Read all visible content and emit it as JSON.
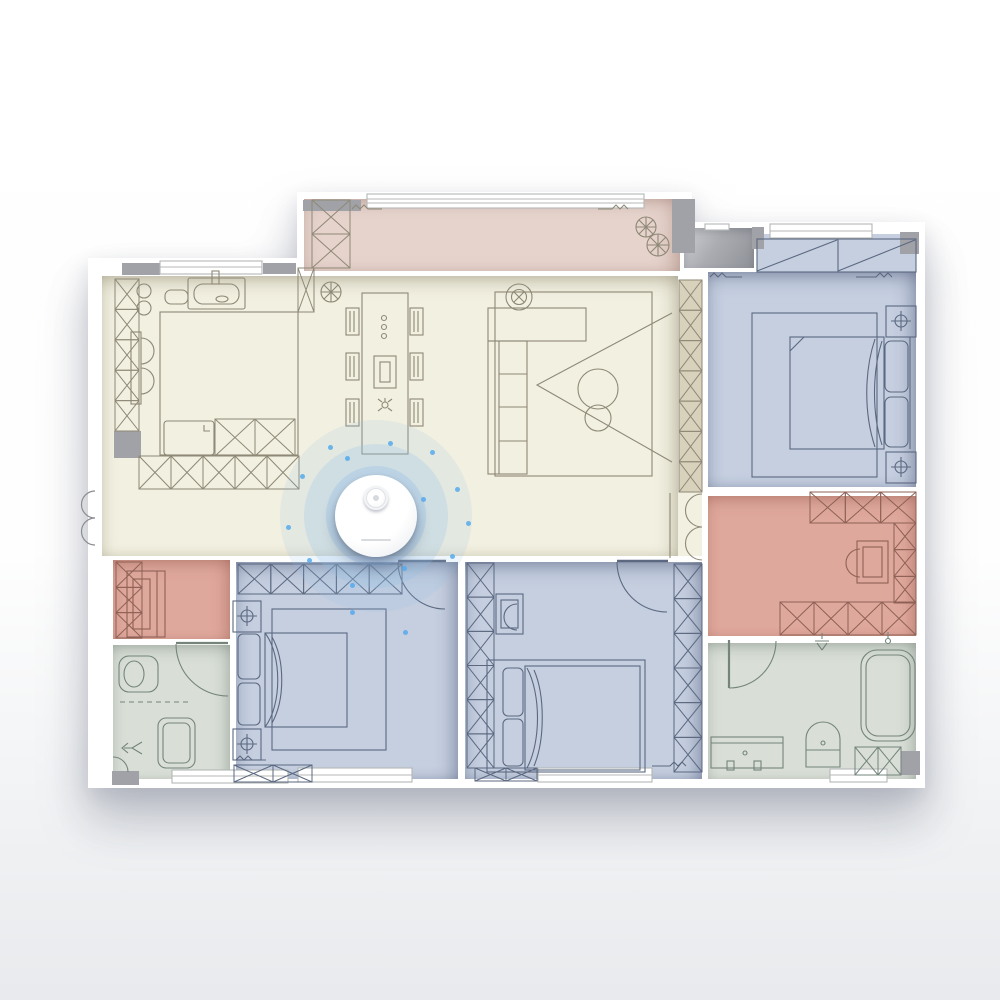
{
  "map": {
    "type": "floor-plan",
    "wall_color": "#ffffff",
    "pillar_color": "#a0a2a7",
    "background_top": "#ffffff",
    "background_bottom": "#e8eaed"
  },
  "rooms": [
    {
      "id": "balcony",
      "label": "balcony",
      "color": "#e6d3cc"
    },
    {
      "id": "living",
      "label": "living-dining-kitchen",
      "color": "#f2f0e1"
    },
    {
      "id": "bedroom-right",
      "label": "bedroom-top-right",
      "color": "#c5cfe0"
    },
    {
      "id": "study",
      "label": "study-right",
      "color": "#dfa89c"
    },
    {
      "id": "bathroom-right",
      "label": "bathroom-bottom-right",
      "color": "#d9dfd7"
    },
    {
      "id": "bedroom-center",
      "label": "bedroom-bottom-center",
      "color": "#c5cfe0"
    },
    {
      "id": "bedroom-master",
      "label": "bedroom-bottom-left",
      "color": "#c5cfe0"
    },
    {
      "id": "bathroom-left",
      "label": "bathroom-left",
      "color": "#d9dfd7"
    },
    {
      "id": "storage",
      "label": "storage-left",
      "color": "#dfa89c"
    },
    {
      "id": "corridor",
      "label": "entry-ledge-top-right",
      "color": "#a6a8ad"
    }
  ],
  "strokes": {
    "warm": "#8e8876",
    "cool": "#5b6880",
    "green": "#74847b",
    "salmon": "#8f6156",
    "window": "#b4b7b6",
    "door": "#8a8d92"
  },
  "robot": {
    "device": "robot-vacuum",
    "x": 376,
    "y": 516,
    "body_color": "#ffffff",
    "halo_color": "#a9cdea",
    "particle_color": "#55a9ec",
    "rings": 3,
    "particles": [
      [
        302,
        476
      ],
      [
        347,
        458
      ],
      [
        390,
        443
      ],
      [
        432,
        452
      ],
      [
        457,
        489
      ],
      [
        468,
        523
      ],
      [
        452,
        556
      ],
      [
        404,
        568
      ],
      [
        352,
        585
      ],
      [
        309,
        560
      ],
      [
        288,
        527
      ],
      [
        330,
        447
      ],
      [
        405,
        632
      ],
      [
        352,
        612
      ],
      [
        423,
        499
      ]
    ]
  },
  "icons": [
    "plant-icon",
    "ceiling-fan-icon",
    "lamp-icon",
    "shower-icon",
    "sink-icon",
    "toilet-icon",
    "bathtub-icon"
  ]
}
